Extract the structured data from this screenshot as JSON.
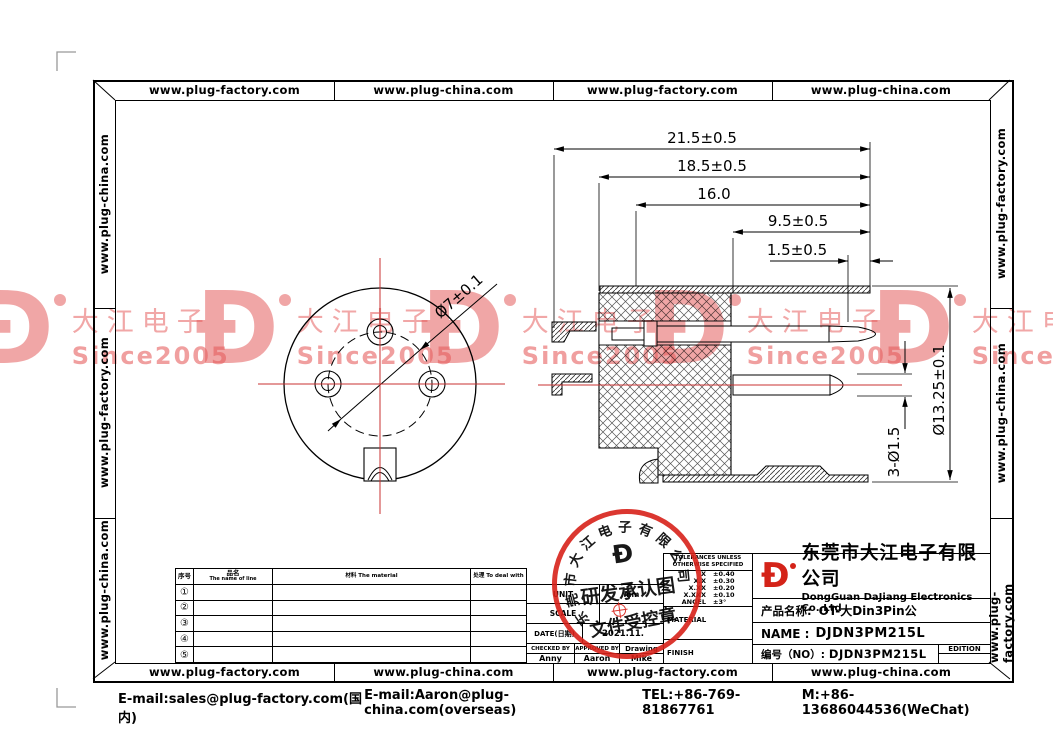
{
  "frame": {
    "top_cells": [
      "www.plug-factory.com",
      "www.plug-china.com",
      "www.plug-factory.com",
      "www.plug-china.com"
    ],
    "bottom_cells": [
      "www.plug-factory.com",
      "www.plug-china.com",
      "www.plug-factory.com",
      "www.plug-china.com"
    ],
    "left_cells": [
      "www.plug-china.com",
      "www.plug-factory.com",
      "www.plug-china.com"
    ],
    "right_cells": [
      "www.plug-factory.com",
      "www.plug-china.com",
      "www.plug-factory.com"
    ]
  },
  "watermark": {
    "logo_glyph": "Ð",
    "line1": "大江电子",
    "line2": "Since2005",
    "color": "#e65c5c"
  },
  "stamp": {
    "arc_text": "东莞市大江电子有限公司",
    "logo_glyph": "Ð",
    "line1": "研发承认图",
    "line2": "文件受控章",
    "color": "#d8221a"
  },
  "dims": {
    "total": "21.5±0.5",
    "body": "18.5±0.5",
    "mid": "16.0",
    "front": "9.5±0.5",
    "tip": "1.5±0.5",
    "shell_dia": "Ø13.25±0.1",
    "pin_dia": "3-Ø1.5",
    "bolt_circle": "Ø7±0.1"
  },
  "parts_table": {
    "col1": "序号",
    "col2_cn": "品名",
    "col2_en": "The name of line",
    "col3": "材料 The material",
    "col4": "处理 To deal with",
    "rows": [
      "①",
      "②",
      "③",
      "④",
      "⑤"
    ]
  },
  "info_table": {
    "unit_label": "UNIT",
    "unit_value": "mm",
    "scale_label": "SCALE",
    "scale_value": "",
    "date_label": "DATE(日期)",
    "date_value": "2021.11.",
    "checked_label": "CHECKED BY",
    "approved_label": "APPROVED BY",
    "drawing_label": "Drawing",
    "checked_name": "Anny",
    "approved_name": "Aaron",
    "drawing_name": "Mike"
  },
  "tolerance": {
    "header1": "TOLERANCES UNLESS",
    "header2": "OTHERWISE SPECIFIED",
    "rows": [
      {
        "label": "X",
        "value": "±0.40"
      },
      {
        "label": "X.X",
        "value": "±0.30"
      },
      {
        "label": "X.XX",
        "value": "±0.20"
      },
      {
        "label": "X.XXX",
        "value": "±0.10"
      },
      {
        "label": "ANGEL",
        "value": "±3°"
      }
    ],
    "material_label": "MATERIAL",
    "finish_label": "FINISH"
  },
  "title_block": {
    "logo_glyph": "Ð",
    "company_cn": "东莞市大江电子有限公司",
    "company_en": "DongGuan DaJiang Electronics Co.,Ltd",
    "product_label": "产品名称:",
    "product_value": "OT-大Din3Pin公",
    "name_label": "NAME :",
    "name_value": "DJDN3PM215L",
    "no_label": "编号（NO）:",
    "no_value": "DJDN3PM215L",
    "edition_label": "EDITION"
  },
  "footer": {
    "email_domestic": "E-mail:sales@plug-factory.com(国内)",
    "email_overseas": "E-mail:Aaron@plug-china.com(overseas)",
    "tel": "TEL:+86-769-81867761",
    "mobile": "M:+86-13686044536(WeChat)"
  }
}
